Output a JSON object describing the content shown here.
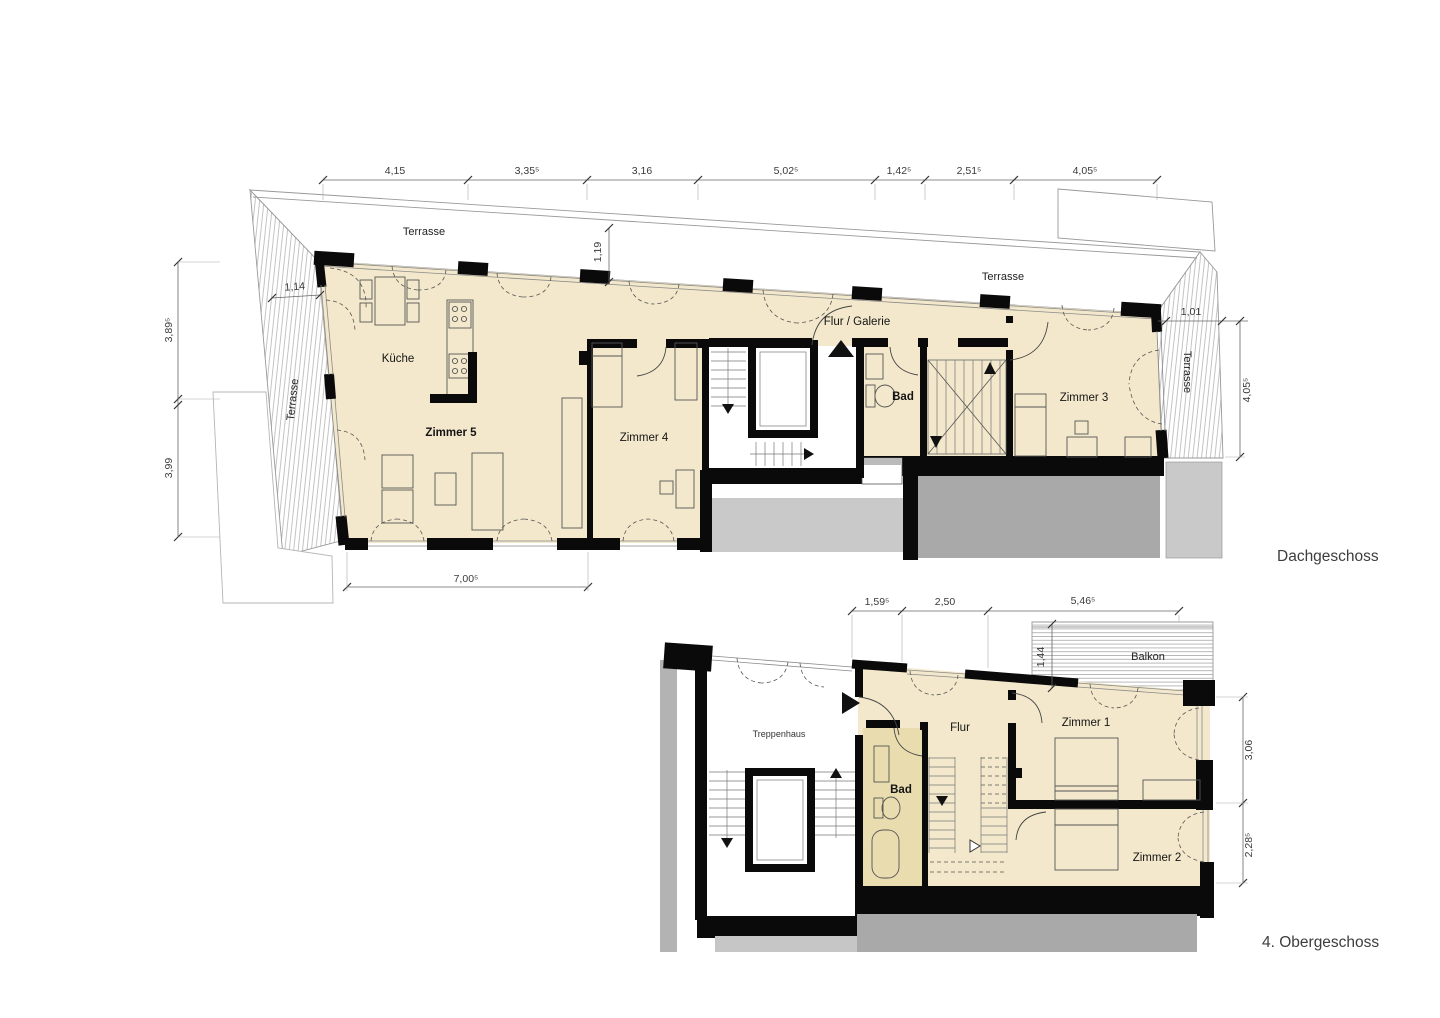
{
  "dg": {
    "title": "Dachgeschoss",
    "terrasse_top": "Terrasse",
    "terrasse_left": "Terrasse",
    "terrasse_right": "Terrasse",
    "kueche": "Küche",
    "zimmer5": "Zimmer 5",
    "zimmer4": "Zimmer 4",
    "flur_galerie": "Flur / Galerie",
    "bad": "Bad",
    "zimmer3": "Zimmer 3",
    "dims_top": [
      "4,15",
      "3,35⁵",
      "3,16",
      "5,02⁵",
      "1,42⁵",
      "2,51⁵",
      "4,05⁵"
    ],
    "dims_left": [
      "3,89⁵",
      "3,99"
    ],
    "dim_1_14": "1,14",
    "dim_1_19": "1,19",
    "dim_bottom": "7,00⁵",
    "dim_1_01": "1,01",
    "dim_right": "4,05⁵"
  },
  "og": {
    "title": "4. Obergeschoss",
    "balkon": "Balkon",
    "treppenhaus": "Treppenhaus",
    "flur": "Flur",
    "bad": "Bad",
    "zimmer1": "Zimmer 1",
    "zimmer2": "Zimmer 2",
    "dims_top": [
      "1,59⁵",
      "2,50",
      "5,46⁵"
    ],
    "dims_right": [
      "3,06",
      "2,28⁵"
    ],
    "dim_balkon": "1,44"
  },
  "colors": {
    "room_fill": "#f3e8cb",
    "bath_fill": "#e9ddb0",
    "roof_dark": "#a9a9a9",
    "roof_light": "#c9c9c9",
    "wall": "#0a0a0a"
  }
}
